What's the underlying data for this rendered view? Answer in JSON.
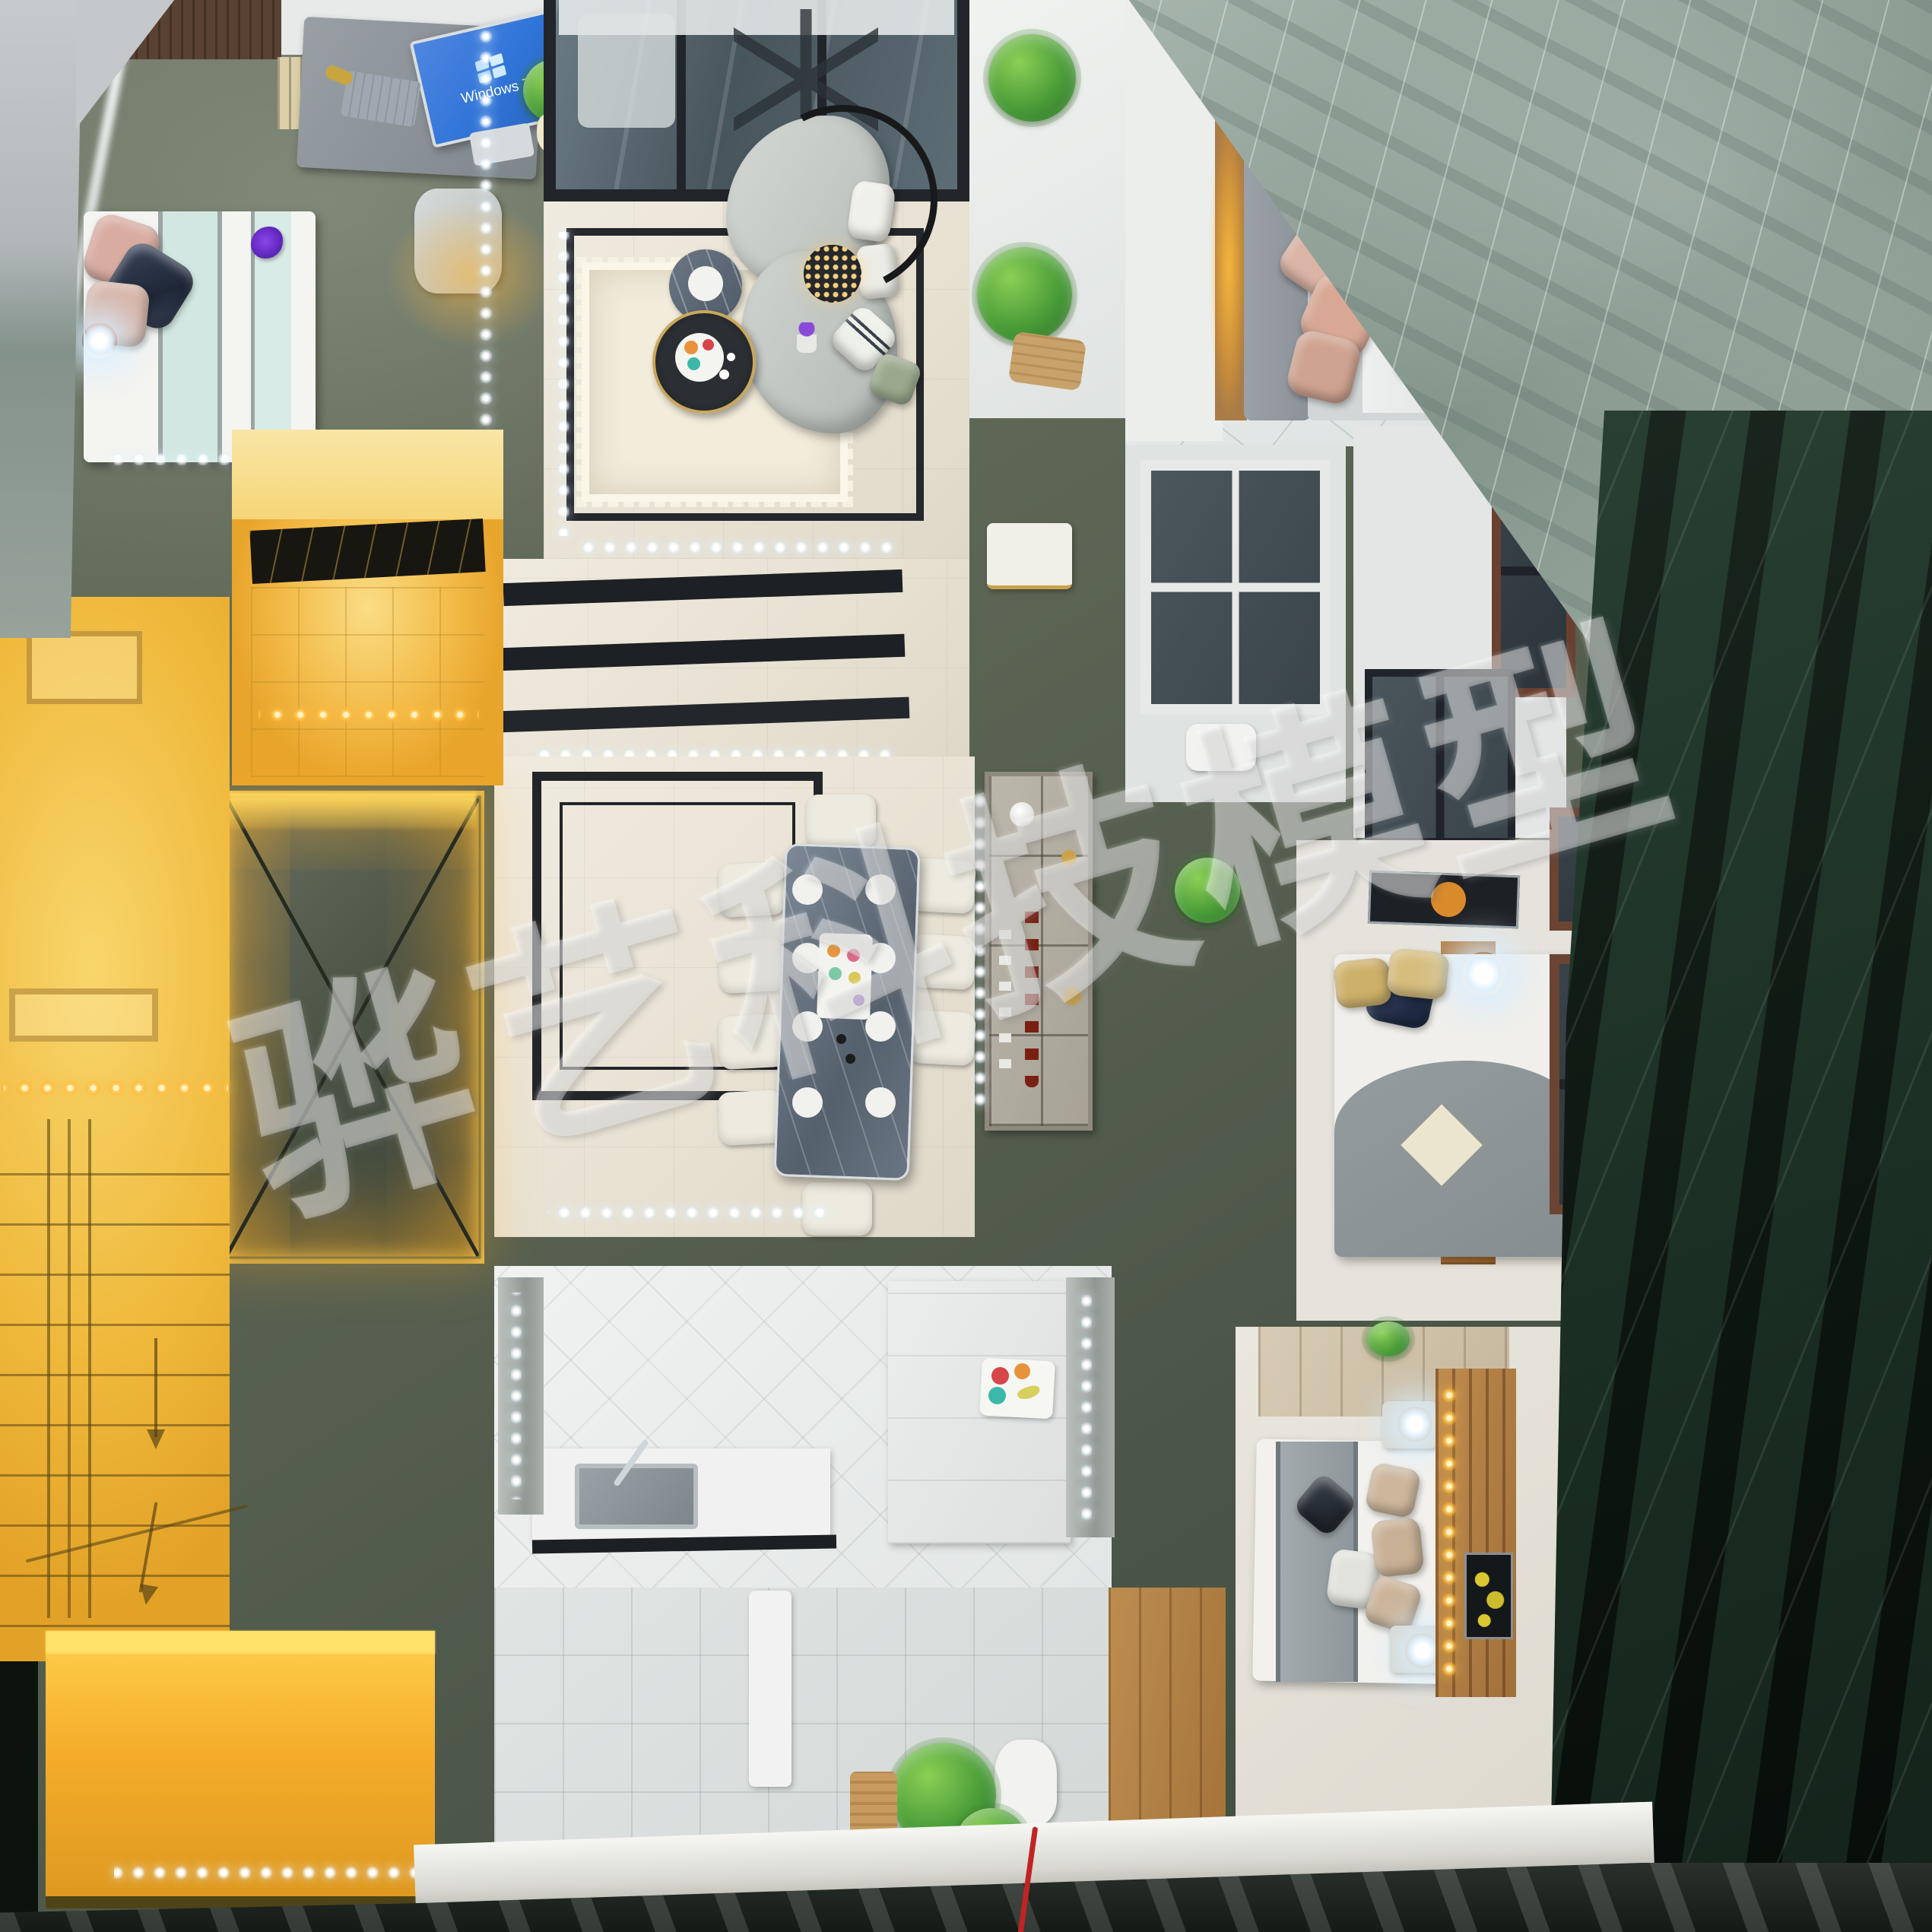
{
  "scene": {
    "watermark": {
      "text": "骅艺科技模型",
      "color": "#ffffff",
      "opacity": 0.34,
      "angle_deg": -16
    },
    "monitor": {
      "os_label": "Windows 7",
      "screen_color": "#2f74d8"
    }
  },
  "palette": {
    "model_wall": "#5d6655",
    "table_marble_dark": "#15211a",
    "marble_gray_green": "#8a9a90",
    "warm_glow": "#f2b33a",
    "led_cool": "#ffffff",
    "wood": "#a8713d",
    "floor_cream": "#e9e3d6",
    "glass_blue": "#5f7078"
  }
}
